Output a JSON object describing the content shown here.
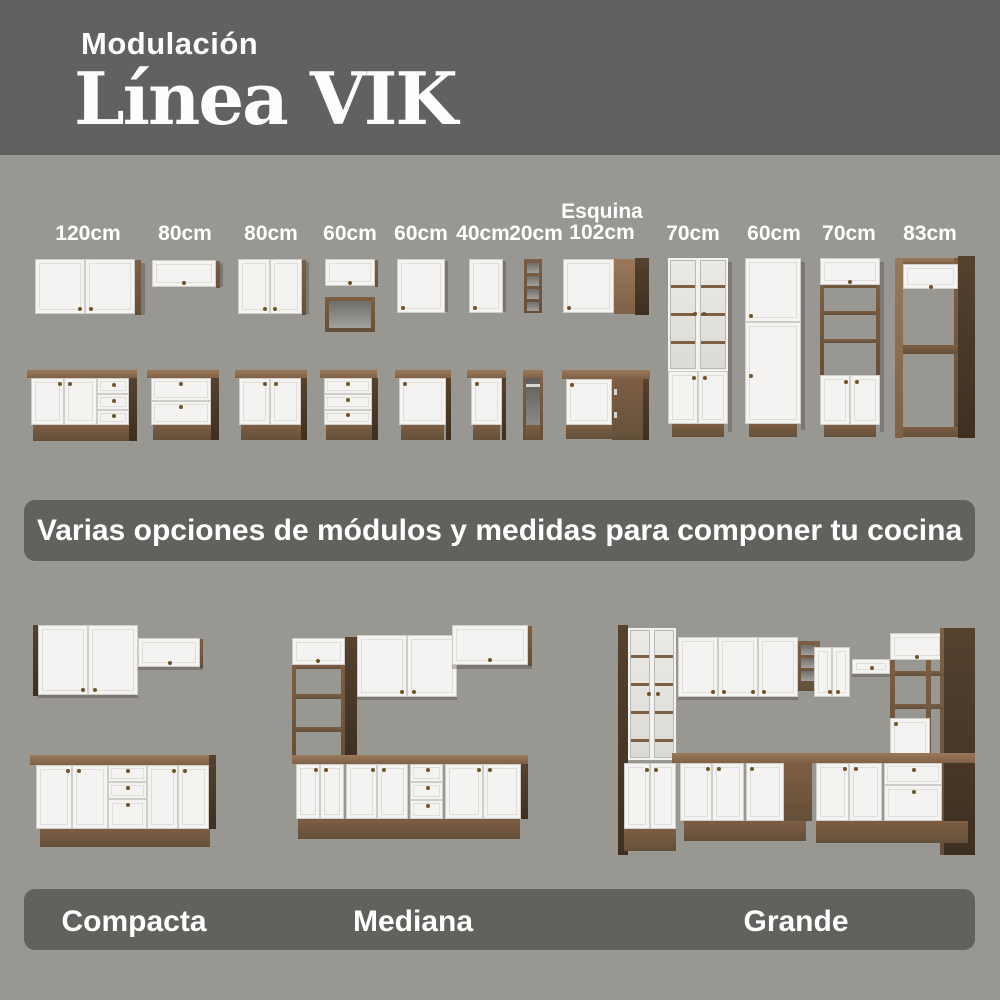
{
  "header": {
    "kicker": "Modulación",
    "title": "Línea VIK"
  },
  "modules": {
    "labels": [
      {
        "text": "120cm"
      },
      {
        "text": "80cm"
      },
      {
        "text": "80cm"
      },
      {
        "text": "60cm"
      },
      {
        "text": "60cm"
      },
      {
        "text": "40cm"
      },
      {
        "text": "20cm"
      },
      {
        "line1": "Esquina",
        "line2": "102cm"
      },
      {
        "text": "70cm"
      },
      {
        "text": "60cm"
      },
      {
        "text": "70cm"
      },
      {
        "text": "83cm"
      }
    ]
  },
  "banner": {
    "text": "Varias opciones de módulos y medidas para componer tu cocina"
  },
  "kitchens": {
    "items": [
      {
        "label": "Compacta"
      },
      {
        "label": "Mediana"
      },
      {
        "label": "Grande"
      }
    ]
  },
  "colors": {
    "header_bg": "#636160",
    "page_bg": "#999792",
    "banner_bg": "#63615e",
    "cabinet_white": "#f3f2f0",
    "wood_light": "#8a6a4d",
    "wood_mid": "#6e5138",
    "wood_dark": "#4a392a",
    "knob_brass": "#6f5428",
    "text": "#ffffff"
  }
}
